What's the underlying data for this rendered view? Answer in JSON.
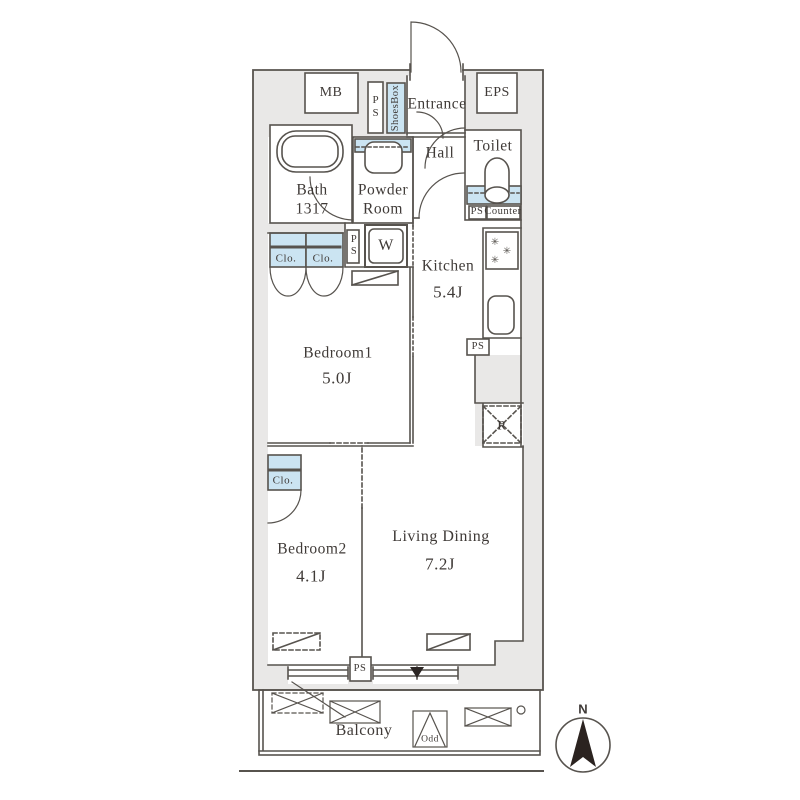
{
  "plan": {
    "type": "apartment-floor-plan",
    "colors": {
      "wall_fill": "#e9e8e7",
      "line": "#57534e",
      "accent_blue": "#cbe4f2",
      "text": "#3f3a37"
    },
    "labels": {
      "mb": "MB",
      "ps": "PS",
      "shoes_box": "ShoesBox",
      "entrance": "Entrance",
      "eps": "EPS",
      "hall": "Hall",
      "toilet": "Toilet",
      "bath_name": "Bath",
      "bath_size": "1317",
      "powder_line1": "Powder",
      "powder_line2": "Room",
      "closet": "Clo.",
      "washer": "W",
      "kitchen_name": "Kitchen",
      "kitchen_area": "5.4J",
      "counter": "Counter",
      "fridge": "R",
      "bedroom1_name": "Bedroom1",
      "bedroom1_area": "5.0J",
      "bedroom2_name": "Bedroom2",
      "bedroom2_area": "4.1J",
      "living_name": "Living Dining",
      "living_area": "7.2J",
      "balcony": "Balcony",
      "odd": "Odd",
      "compass_north": "N"
    },
    "icons": {
      "stove_burner": "✳"
    }
  }
}
